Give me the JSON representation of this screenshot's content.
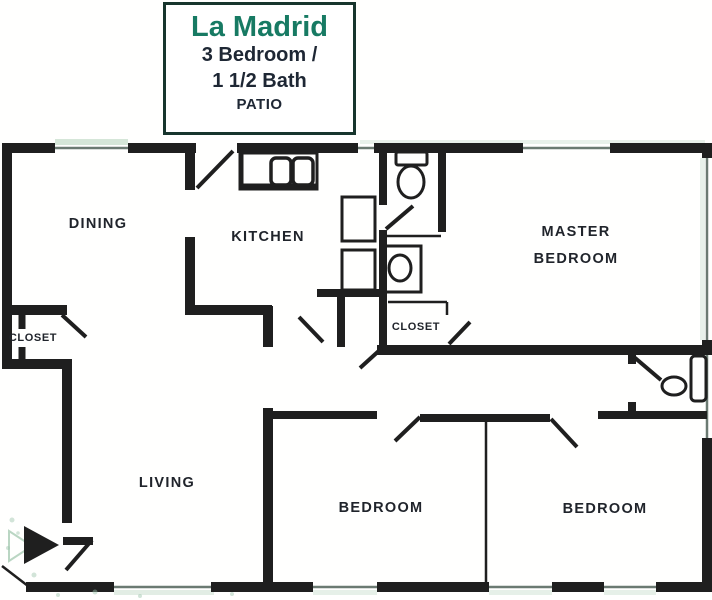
{
  "title_card": {
    "name": "La Madrid",
    "subtitle_line1": "3 Bedroom /",
    "subtitle_line2": "1 1/2 Bath",
    "subtitle_line3": "PATIO"
  },
  "rooms": {
    "dining": "DINING",
    "kitchen": "KITCHEN",
    "living": "LIVING",
    "master_line1": "MASTER",
    "master_line2": "BEDROOM",
    "bedroom_left": "BEDROOM",
    "bedroom_right": "BEDROOM",
    "closet_entry": "CLOSET",
    "closet_master": "CLOSET"
  },
  "colors": {
    "accent_teal": "#177a63",
    "title_text": "#1e2734",
    "wall": "#1f1f1f",
    "window_line": "#6b7a72",
    "window_tint": "#d5e6d8",
    "noise_green": "#9cc4aa"
  },
  "icons": {
    "entry_arrow": "solid right-pointing triangle marking unit entry",
    "toilet_main_bath": "toilet with tank, plan view",
    "toilet_half_bath": "toilet bowl, plan view",
    "sink_vanity": "oval basin in vanity counter",
    "kitchen_double_sink": "double-basin kitchen sink in counter",
    "refrigerator": "refrigerator outline, plan view",
    "range": "range/stove outline, plan view"
  }
}
